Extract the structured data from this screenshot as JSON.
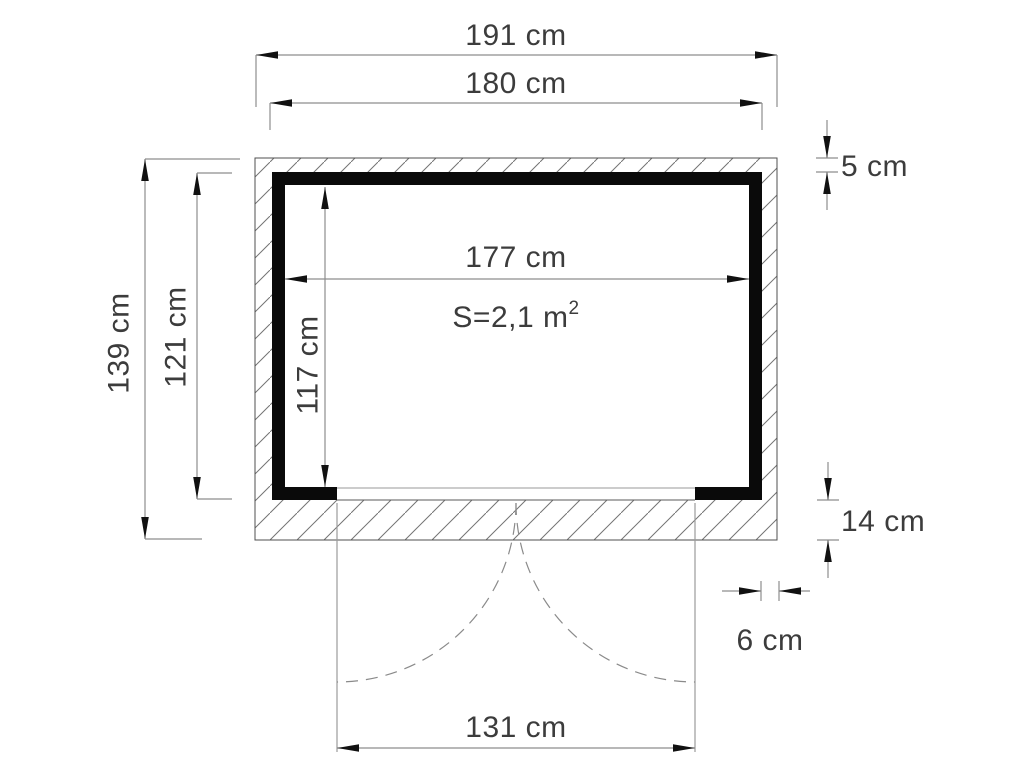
{
  "figure": {
    "type": "floor-plan",
    "subject": "shed-ground-plan-with-double-door",
    "unit": "cm",
    "labels": {
      "outer_width": "191 cm",
      "frame_width": "180 cm",
      "wall_thickness_top": "5 cm",
      "outer_depth": "139 cm",
      "frame_depth": "121 cm",
      "interior_width": "177 cm",
      "interior_depth": "117 cm",
      "area_main": "S=2,1 m",
      "area_exponent": "2",
      "base_height": "14 cm",
      "wall_thickness_side": "6 cm",
      "door_opening": "131 cm"
    },
    "dimensions_cm": {
      "outer_width": 191,
      "frame_width": 180,
      "wall_thickness_top": 5,
      "outer_depth": 139,
      "frame_depth": 121,
      "interior_width": 177,
      "interior_depth": 117,
      "base_height": 14,
      "wall_thickness_side": 6,
      "door_opening": 131,
      "area_m2": 2.1
    },
    "colors": {
      "wall_fill": "#0a0a0a",
      "hatch_line": "#737373",
      "dimension_line": "#8e8e8e",
      "text": "#3c3c3c",
      "arrow": "#111111",
      "background": "#ffffff"
    }
  }
}
